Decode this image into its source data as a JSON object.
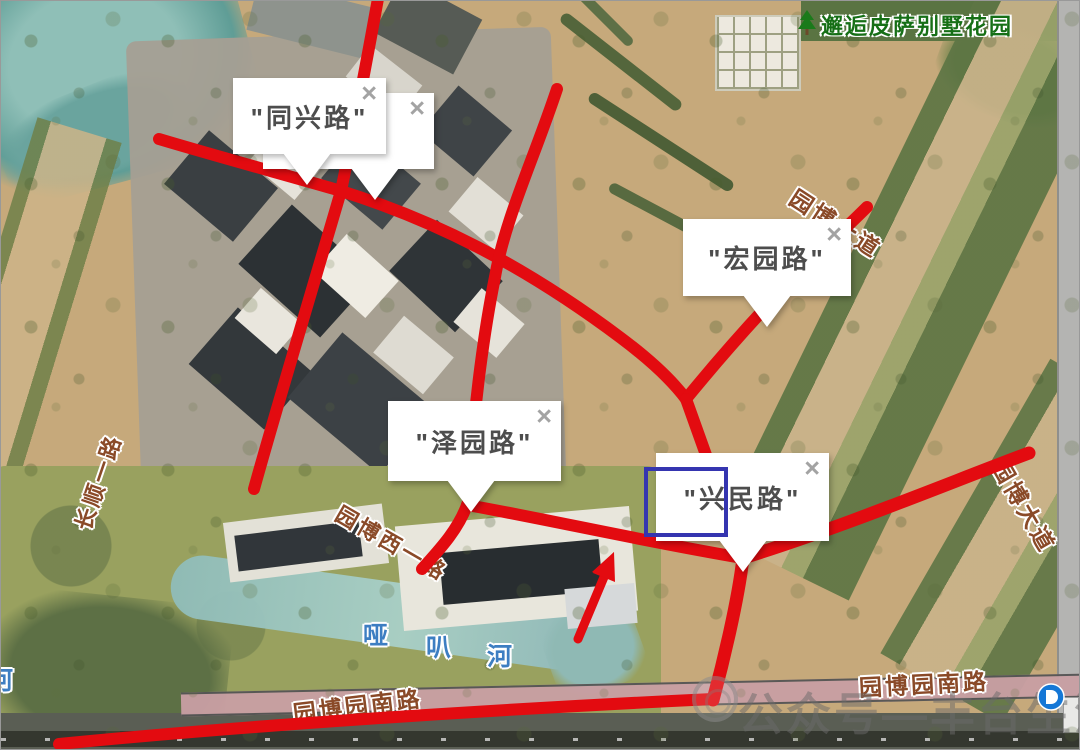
{
  "app": {
    "type": "satellite-map-annotation-view"
  },
  "ui": {
    "close_glyph": "×"
  },
  "popups": {
    "tongxing": {
      "label": "\"同兴路\""
    },
    "hongyuan": {
      "label": "\"宏园路\""
    },
    "zeyuan": {
      "label": "\"泽园路\""
    },
    "xingmin": {
      "label": "\"兴民路\""
    }
  },
  "map_labels": {
    "poi_villa": "邂逅皮萨别墅花园",
    "road_changshun": "长顺一路",
    "road_yuanbo_xi": "园博西一路",
    "road_yuanbo_dadao_top": "园博大道",
    "road_yuanbo_dadao_right": "园博大道",
    "road_yuanbo_nan_left": "园博园南路",
    "road_yuanbo_nan_right": "园博园南路",
    "river_char_1": "哑",
    "river_char_2": "叭",
    "river_char_3": "河",
    "edge_partial_char": "河"
  },
  "watermark": {
    "text": "公众号—丰台生活圈儿"
  },
  "colors": {
    "route_red": "#e30b10",
    "annotation_blue": "#3535b0",
    "road_label_brown": "#8a4a28",
    "river_label_blue": "#3d7ec2",
    "poi_label_green": "#166f16",
    "metro_blue": "#1577d6"
  }
}
